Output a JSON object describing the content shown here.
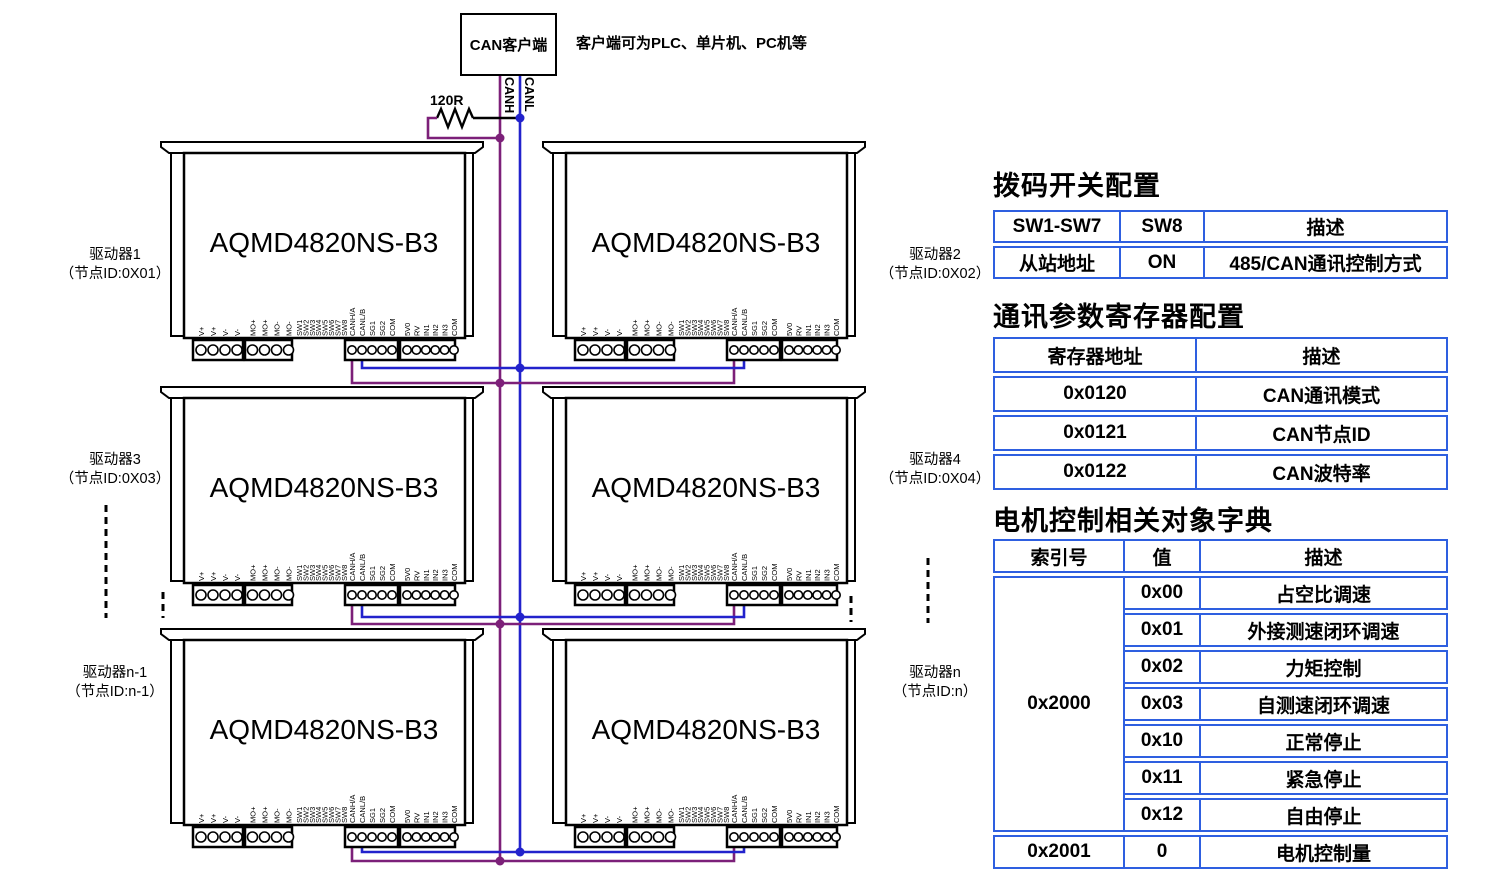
{
  "colors": {
    "can_h": "#7c2079",
    "can_l": "#2222cc",
    "table_border": "#2e5fe0"
  },
  "top": {
    "client_box": "CAN客户端",
    "note": "客户端可为PLC、单片机、PC机等",
    "resistor": "120R",
    "bus_h": "CANH",
    "bus_l": "CANL"
  },
  "driver": {
    "model": "AQMD4820NS-B3",
    "pins": {
      "power": [
        "V+",
        "V+",
        "V-",
        "V-"
      ],
      "motor": [
        "MO+",
        "MO+",
        "MO-",
        "MO-"
      ],
      "dip": [
        "SW1",
        "SW2",
        "SW3",
        "SW4",
        "SW5",
        "SW6",
        "SW7",
        "SW8"
      ],
      "comm": [
        "CANH/A",
        "CANL/B",
        "SG1",
        "SG2",
        "COM"
      ],
      "io": [
        "5V0",
        "RV",
        "IN1",
        "IN2",
        "IN3",
        "COM"
      ]
    }
  },
  "drivers": [
    {
      "name": "驱动器1",
      "node": "（节点ID:0X01）",
      "side": "left",
      "row": 0
    },
    {
      "name": "驱动器2",
      "node": "（节点ID:0X02）",
      "side": "right",
      "row": 0
    },
    {
      "name": "驱动器3",
      "node": "（节点ID:0X03）",
      "side": "left",
      "row": 1
    },
    {
      "name": "驱动器4",
      "node": "（节点ID:0X04）",
      "side": "right",
      "row": 1
    },
    {
      "name": "驱动器n-1",
      "node": "（节点ID:n-1）",
      "side": "left",
      "row": 2
    },
    {
      "name": "驱动器n",
      "node": "（节点ID:n）",
      "side": "right",
      "row": 2
    }
  ],
  "tables": {
    "dip": {
      "title": "拨码开关配置",
      "headers": [
        "SW1-SW7",
        "SW8",
        "描述"
      ],
      "rows": [
        [
          "从站地址",
          "ON",
          "485/CAN通讯控制方式"
        ]
      ]
    },
    "reg": {
      "title": "通讯参数寄存器配置",
      "headers": [
        "寄存器地址",
        "描述"
      ],
      "rows": [
        [
          "0x0120",
          "CAN通讯模式"
        ],
        [
          "0x0121",
          "CAN节点ID"
        ],
        [
          "0x0122",
          "CAN波特率"
        ]
      ]
    },
    "obj": {
      "title": "电机控制相关对象字典",
      "headers": [
        "索引号",
        "值",
        "描述"
      ],
      "group_index": "0x2000",
      "group_rows": [
        [
          "0x00",
          "占空比调速"
        ],
        [
          "0x01",
          "外接测速闭环调速"
        ],
        [
          "0x02",
          "力矩控制"
        ],
        [
          "0x03",
          "自测速闭环调速"
        ],
        [
          "0x10",
          "正常停止"
        ],
        [
          "0x11",
          "紧急停止"
        ],
        [
          "0x12",
          "自由停止"
        ]
      ],
      "last_row": [
        "0x2001",
        "0",
        "电机控制量"
      ]
    }
  }
}
